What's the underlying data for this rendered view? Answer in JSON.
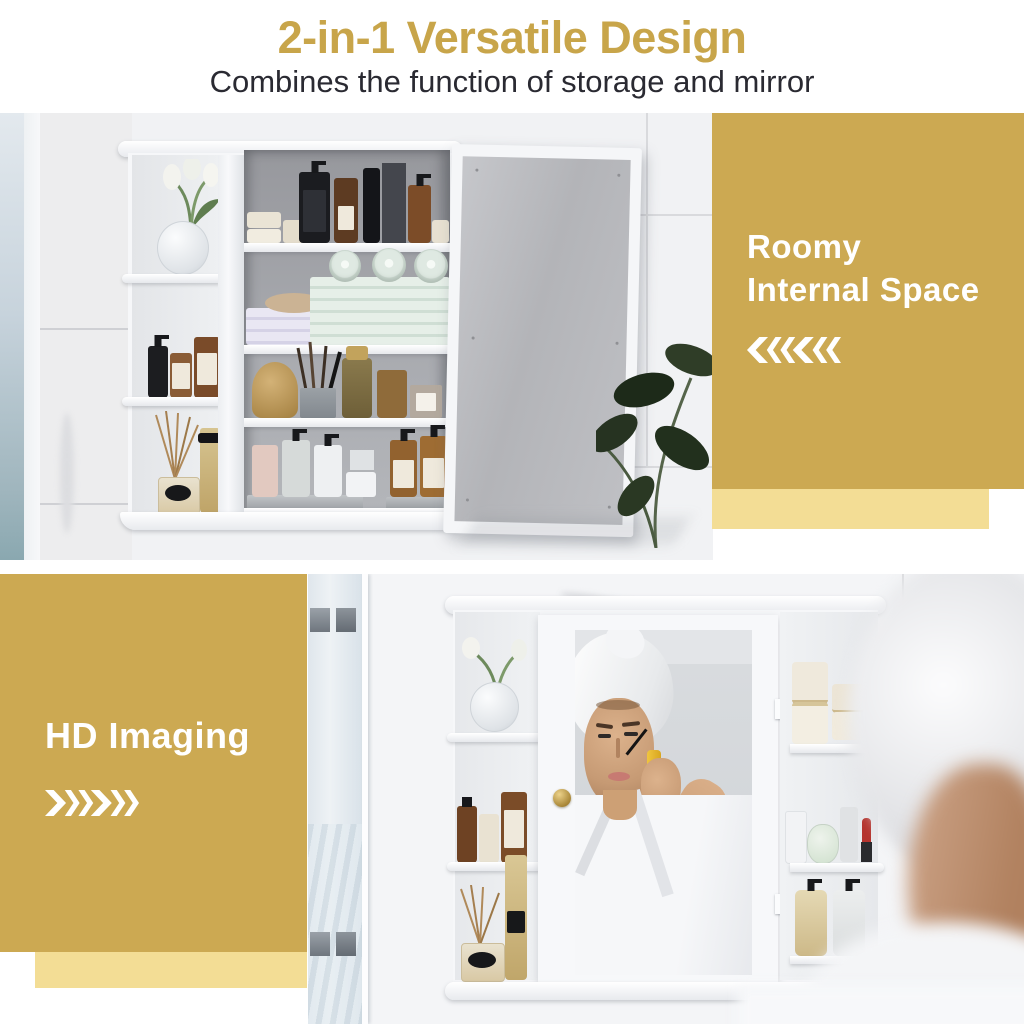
{
  "header": {
    "title": "2-in-1 Versatile Design",
    "subtitle": "Combines the function of storage and mirror"
  },
  "panels": {
    "roomy": {
      "line1": "Roomy",
      "line2": "Internal Space",
      "icon": "triple-chevron-left-icon",
      "direction": "left"
    },
    "hd": {
      "label": "HD Imaging",
      "icon": "triple-chevron-right-icon",
      "direction": "right"
    }
  },
  "colors": {
    "gold_panel": "#CCA952",
    "gold_panel_light": "#F3DD95",
    "title_gold": "#C8A54A",
    "subtitle_text": "#2A2A32",
    "panel_text": "#FFFFFF"
  }
}
